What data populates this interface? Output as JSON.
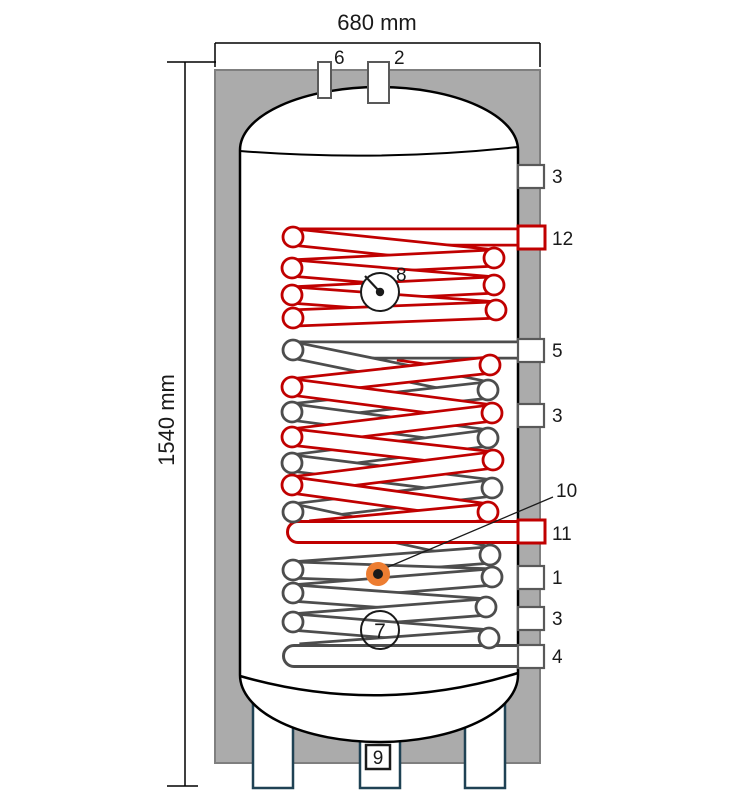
{
  "dimensions": {
    "width": "680 mm",
    "height": "1540 mm"
  },
  "ports": {
    "top6": "6",
    "top2": "2",
    "r1": "3",
    "r2": "12",
    "r3": "5",
    "r4": "3",
    "r5": "11",
    "r6": "1",
    "r7": "3",
    "r8": "4",
    "sensor": "10",
    "bottom": "9"
  },
  "instruments": {
    "thermo_upper": "8",
    "thermo_lower": "7"
  },
  "colors": {
    "solar_coil_red": "#C00000",
    "coil_black": "#4D4D4D",
    "insulation_gray": "#ABABAB",
    "insulation_border": "#7F7F7F",
    "leg_outline": "#1F4254",
    "sensor_orange": "#ED7D31",
    "port_stroke": "#595959"
  }
}
